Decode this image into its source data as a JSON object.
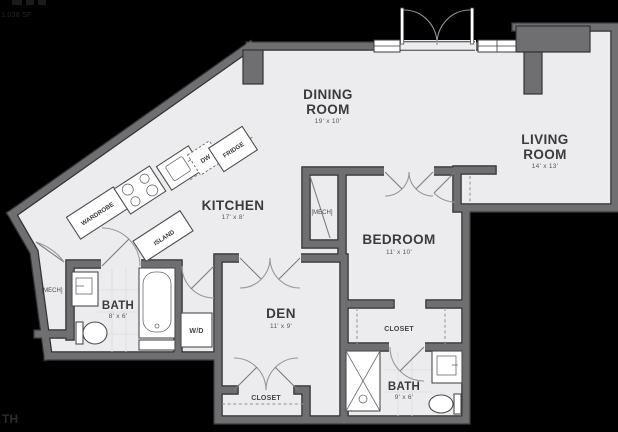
{
  "page": {
    "background": "#000000"
  },
  "plan": {
    "area_text": "1,038 SF",
    "watermark": "TH",
    "rooms": {
      "dining": {
        "line1": "DINING",
        "line2": "ROOM",
        "dim": "19' x 10'"
      },
      "living": {
        "line1": "LIVING",
        "line2": "ROOM",
        "dim": "14' x 13'"
      },
      "kitchen": {
        "label": "KITCHEN",
        "dim": "17' x 8'"
      },
      "bedroom": {
        "label": "BEDROOM",
        "dim": "11' x 10'"
      },
      "den": {
        "label": "DEN",
        "dim": "11' x 9'"
      },
      "bath_main": {
        "label": "BATH",
        "dim": "8' x 6'"
      },
      "bath_second": {
        "label": "BATH",
        "dim": "9' x 6'"
      }
    },
    "features": {
      "closet_bedroom": "CLOSET",
      "closet_den": "CLOSET",
      "washer_dryer": "W/D",
      "mech_entry": "[MECH]",
      "mech_bedroom": "[MECH]",
      "wardrobe": "WARDROBE",
      "island": "ISLAND",
      "fridge": "FRIDGE",
      "dishwasher": "DW"
    },
    "colors": {
      "wall": "#6f6f71",
      "wall_edge": "#323234",
      "floor": "#ececee",
      "label": "#3b3b3d",
      "background": "#000000"
    }
  }
}
